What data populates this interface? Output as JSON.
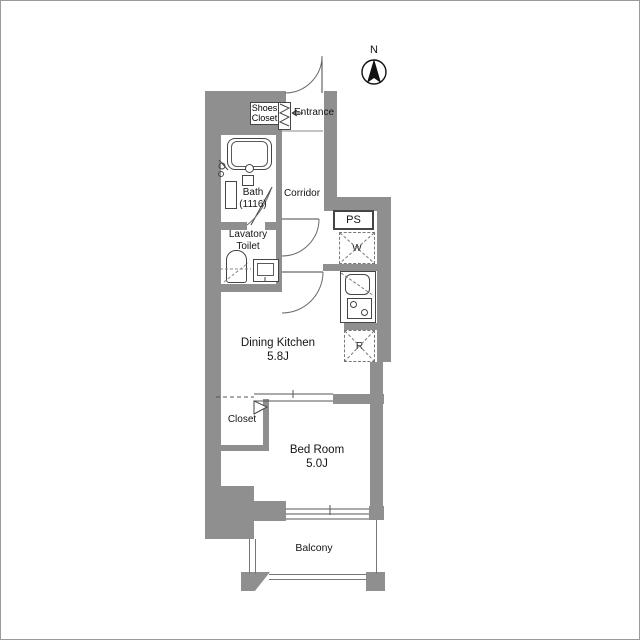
{
  "plan": {
    "compass_label": "N",
    "labels": {
      "shoes_closet_1": "Shoes",
      "shoes_closet_2": "Closet",
      "entrance": "Entrance",
      "corridor": "Corridor",
      "bath_1": "Bath",
      "bath_2": "(1116)",
      "lavatory_1": "Lavatory",
      "lavatory_2": "Toilet",
      "ps": "PS",
      "washer": "W",
      "fridge": "R",
      "dining_kitchen_1": "Dining Kitchen",
      "dining_kitchen_2": "5.8J",
      "closet": "Closet",
      "bedroom_1": "Bed Room",
      "bedroom_2": "5.0J",
      "balcony": "Balcony"
    },
    "colors": {
      "wall": "#8f8f8f",
      "fixture_line": "#454545",
      "door_arc": "#6a6a6a",
      "background": "#ffffff"
    }
  }
}
